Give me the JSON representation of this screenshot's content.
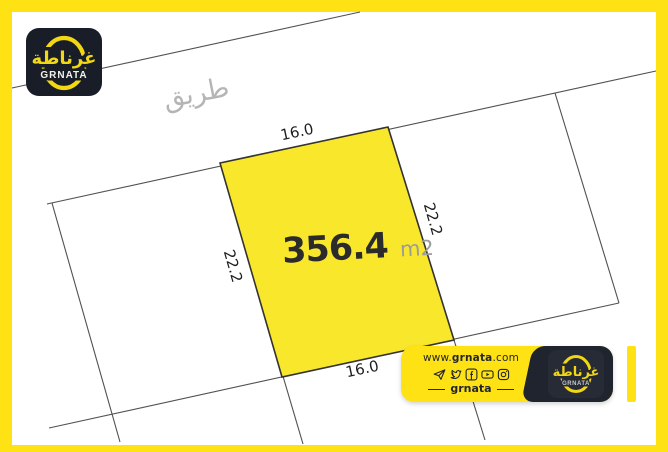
{
  "brand": {
    "arabic_name": "غرناطة",
    "latin_name": "GRNATA"
  },
  "drawing": {
    "road_label": "طريق",
    "plot": {
      "area": "356.4",
      "area_unit": "m2",
      "dim_top": "16.0",
      "dim_bottom": "16.0",
      "dim_left": "22.2",
      "dim_right": "22.2"
    }
  },
  "footer_banner": {
    "website_prefix": "www.",
    "website_name": "grnata",
    "website_suffix": ".com",
    "social_icons": [
      "telegram-icon",
      "twitter-icon",
      "facebook-icon",
      "youtube-icon",
      "instagram-icon"
    ],
    "handle": "grnata",
    "logo_arabic": "غرناطة",
    "logo_latin": "GRNATA"
  },
  "colors": {
    "accent_yellow": "#FFE214",
    "plot_fill": "#F9E72C",
    "logo_dark": "#191D27",
    "banner_dark": "#20242E",
    "line_gray": "#515151",
    "road_label_gray": "#B5B5B5",
    "area_unit_gray": "#9B9B9B"
  }
}
